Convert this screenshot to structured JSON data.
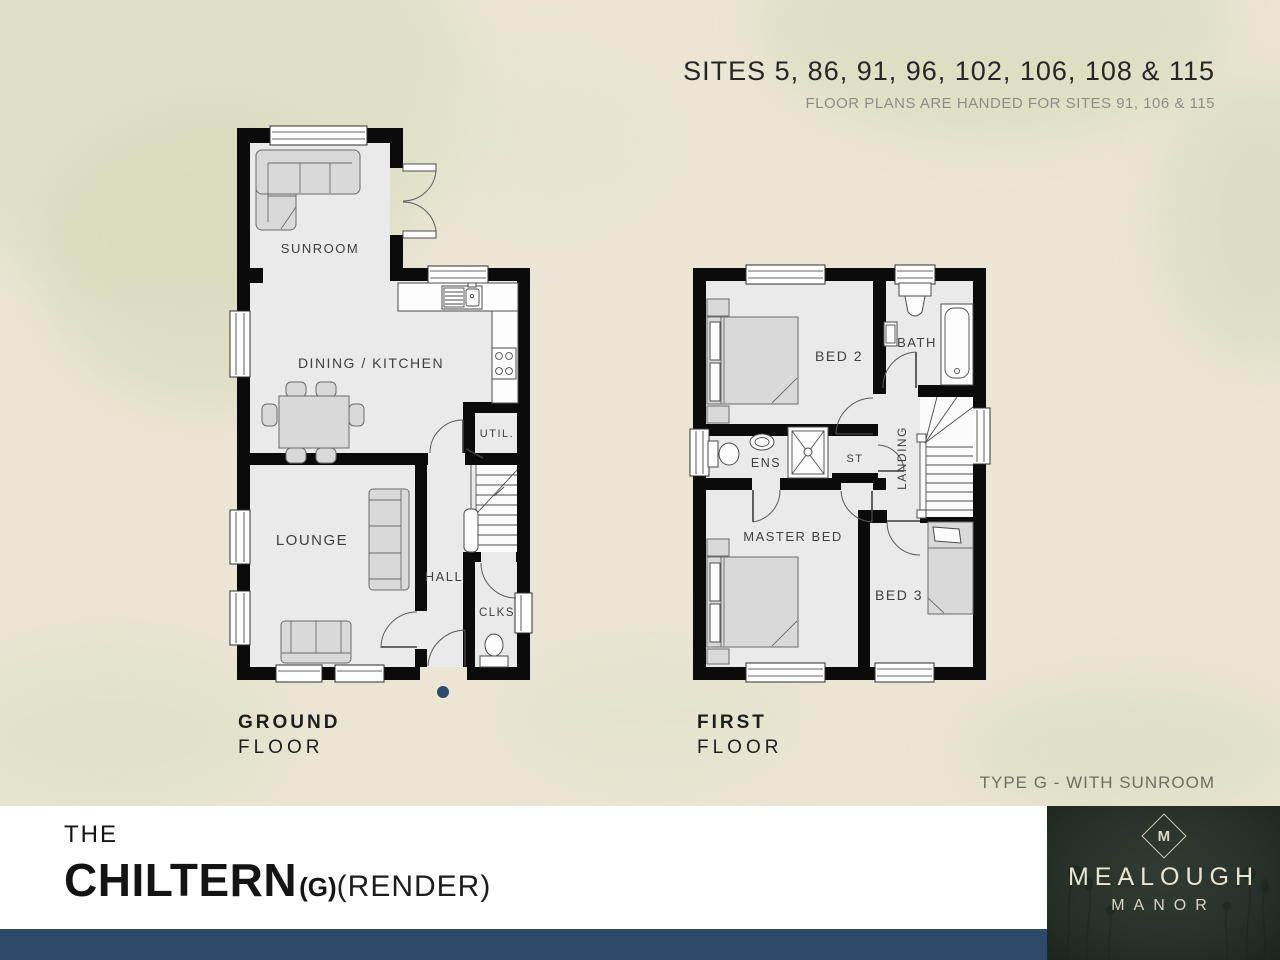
{
  "header": {
    "sites_title": "SITES 5, 86, 91, 96, 102, 106, 108 & 115",
    "sites_note": "FLOOR PLANS ARE HANDED FOR SITES 91, 106 & 115"
  },
  "plans": {
    "ground": {
      "caption_bold": "GROUND",
      "caption_light": "FLOOR",
      "rooms": {
        "sunroom": "SUNROOM",
        "dining": "DINING / KITCHEN",
        "util": "UTIL.",
        "lounge": "LOUNGE",
        "hall": "HALL",
        "clks": "CLKS"
      }
    },
    "first": {
      "caption_bold": "FIRST",
      "caption_light": "FLOOR",
      "rooms": {
        "bed2": "BED 2",
        "bath": "BATH",
        "ens": "ENS",
        "st": "ST",
        "landing": "LANDING",
        "master": "MASTER BED",
        "bed3": "BED 3"
      }
    }
  },
  "type_note": "TYPE G - WITH SUNROOM",
  "title": {
    "prefix": "THE",
    "name": "CHILTERN",
    "variant": "(G)",
    "finish": "(RENDER)"
  },
  "logo": {
    "monogram": "M",
    "name": "MEALOUGH",
    "subtitle": "MANOR"
  },
  "colors": {
    "background_cream": "#ebe5d4",
    "leaf_wash": "#d9ddbd",
    "wall_black": "#0b0b0b",
    "floor_grey": "#eaeaea",
    "navy_bar": "#2e4a6b",
    "entrance_dot": "#2e4a6b",
    "logo_background": "#29322a",
    "logo_text": "#e9e5d3"
  }
}
